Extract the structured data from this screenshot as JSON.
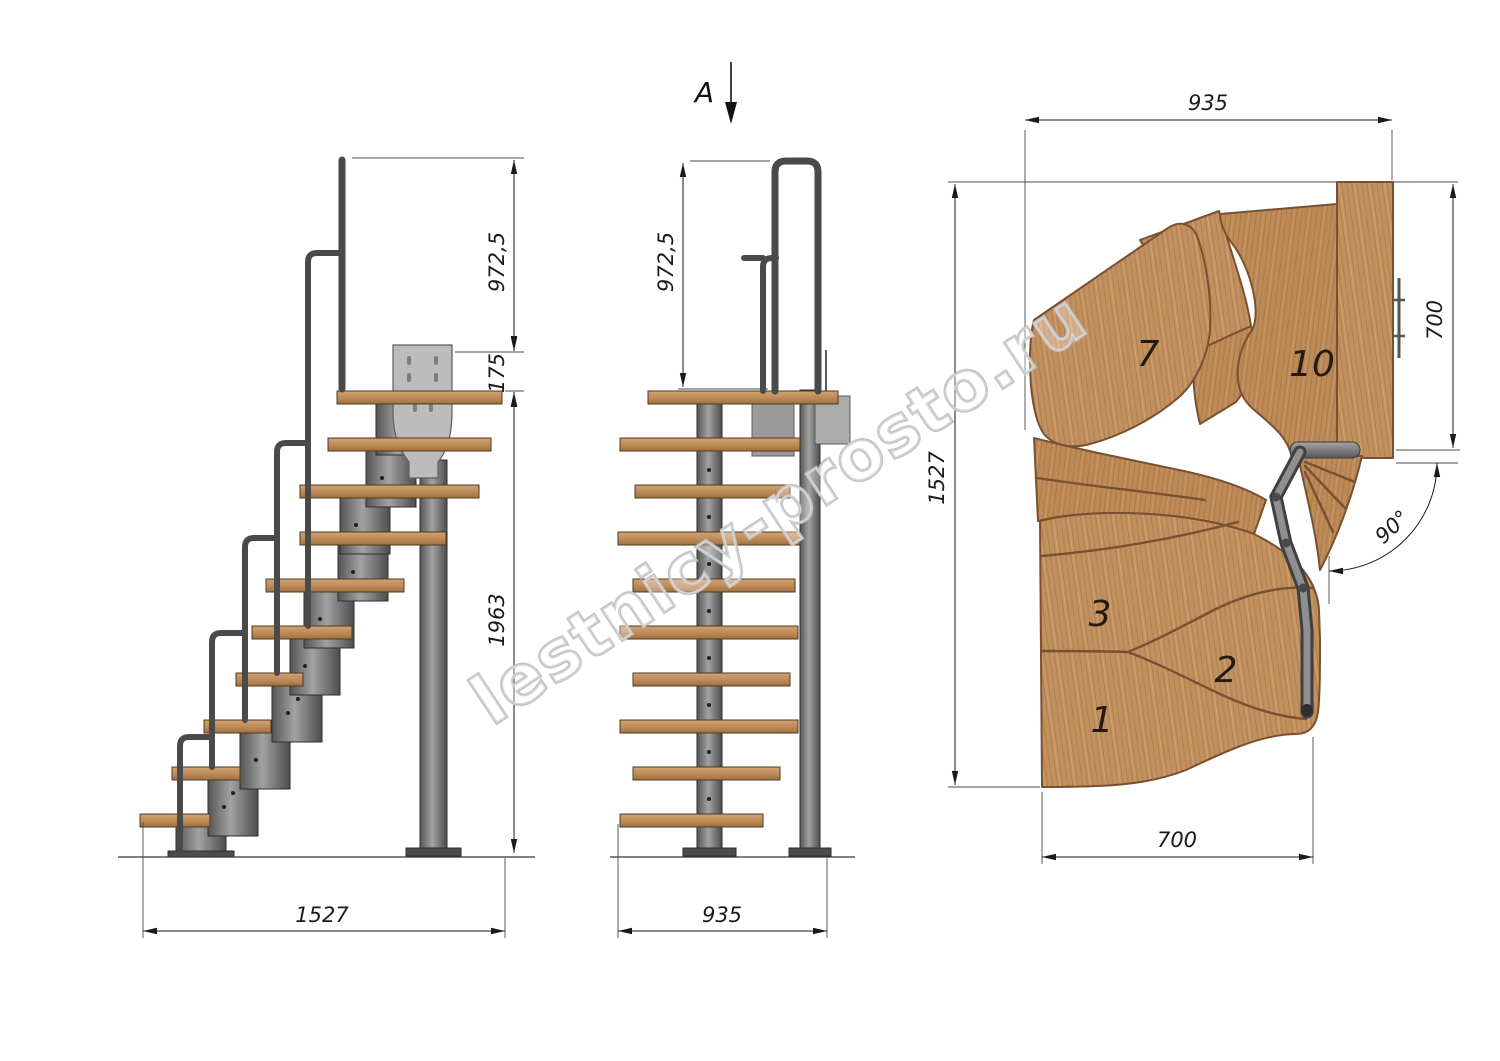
{
  "drawing": {
    "watermark": "lestnicy-prosto.ru",
    "section_arrow_label": "A",
    "side_view": {
      "dim_handrail_height": "972,5",
      "dim_plate_offset": "175",
      "dim_height_below_platform": "1963",
      "dim_total_run": "1527"
    },
    "front_view": {
      "dim_handrail_height": "972,5",
      "dim_width": "935"
    },
    "plan_view": {
      "dim_top_width": "935",
      "dim_landing_depth": "700",
      "dim_total_length": "1527",
      "dim_flight_width": "700",
      "dim_turn_angle": "90°",
      "tread_numbers": {
        "t7": "7",
        "t10": "10",
        "t3": "3",
        "t2": "2",
        "t1": "1"
      }
    },
    "colors": {
      "wood": "#c3915f",
      "wood_dark": "#7a5030",
      "metal": "#787878",
      "metal_dark": "#3f3f3f",
      "plate": "#bcbcbc",
      "line": "#1a1a1a",
      "watermark": "#c4c4c4"
    }
  }
}
